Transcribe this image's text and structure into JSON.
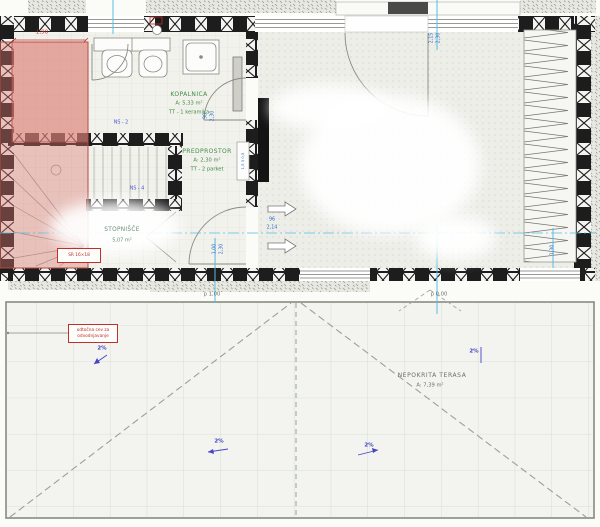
{
  "drawing": {
    "rooms": {
      "kopalnica": {
        "name": "KOPALNICA",
        "area": "A: 5,33 m²",
        "finish": "TT - 1 keramika"
      },
      "predprostor": {
        "name": "PREDPROSTOR",
        "area": "A: 2,30 m²",
        "finish": "TT - 2 parket"
      },
      "stopnisce": {
        "name": "STOPNIŠČE",
        "area": "5,07 m²"
      },
      "terasa": {
        "name": "NEPOKRITA TERASA",
        "area": "A: 7,39 m²"
      }
    },
    "dims": {
      "closet_width": "1,90",
      "win_a": "2,15",
      "win_b": "2,30",
      "door_w": "90",
      "door_h": "2,30",
      "pass_w": "96",
      "pass_l": "2,14",
      "door2_w": "1,00",
      "door2_h": "2,30",
      "win2_w": "1,30",
      "wall_layers": "1,5 3 0,5"
    },
    "marks": {
      "ns2": "NS - 2",
      "ns4": "NS - 4",
      "stair_note": "SR 16×18",
      "red_note_line1": "odtočna cev za",
      "red_note_line2": "odvodnjavanje",
      "level_entry": "p 1,00",
      "level_terrace": "p 0,00",
      "slope": "2%"
    },
    "colors": {
      "pink_highlight": "#dba49d",
      "centerline_cyan": "#56bce4",
      "dim_blue": "#2e6fc4",
      "room_label_green": "#3f8c46",
      "annotation_red": "#c03028"
    }
  }
}
